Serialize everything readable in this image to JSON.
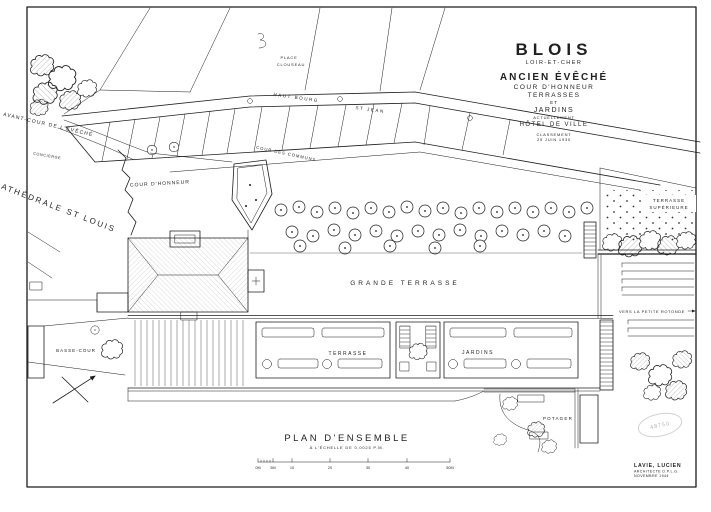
{
  "colors": {
    "ink": "#1c1c1c",
    "paper": "#ffffff",
    "stamp": "#b5b5b5"
  },
  "title_block": {
    "city": "BLOIS",
    "department": "LOIR-ET-CHER",
    "line1": "ANCIEN ÉVÊCHÉ",
    "line2": "COUR D'HONNEUR",
    "line3": "TERRASSES",
    "line4": "ET",
    "line5": "JARDINS",
    "current_use_label": "ACTUELLEMENT",
    "current_use": "HÔTEL DE VILLE",
    "classification_label": "CLASSEMENT",
    "classification_date": "25 JUIN 1930"
  },
  "plan_labels": {
    "avant_cour": "AVANT-COUR DE L'ÉVÊCHÉ",
    "place_line1": "PLACE",
    "place_line2": "CLOUSEAU",
    "concierge": "CONCIERGE",
    "cathedrale": "CATHÉDRALE ST LOUIS",
    "cour_honneur": "COUR D'HONNEUR",
    "cour_communs": "COUR DES COMMUNS",
    "rue_part1": "HAUT BOURG",
    "rue_part2": "ST JEAN",
    "grande_terrasse": "GRANDE TERRASSE",
    "terrasse": "TERRASSE",
    "jardins": "JARDINS",
    "basse_cour": "BASSE-COUR",
    "potager": "POTAGER",
    "terrasse_sup_line1": "TERRASSE",
    "terrasse_sup_line2": "SUPÉRIEURE",
    "vers_rotonde": "VERS LA PETITE ROTONDE"
  },
  "footer": {
    "plan_title": "PLAN D'ENSEMBLE",
    "plan_scale": "À L'ÉCHELLE DE 0,0025 P.M.",
    "scale_ticks": [
      "0M",
      "5M",
      "10",
      "20",
      "30",
      "40",
      "50M"
    ],
    "stamp_number": "48750",
    "architect_name": "LAVIE, LUCIEN",
    "architect_title": "ARCHITECTE D.P.L.G.",
    "architect_date": "NOVEMBRE 1944"
  }
}
